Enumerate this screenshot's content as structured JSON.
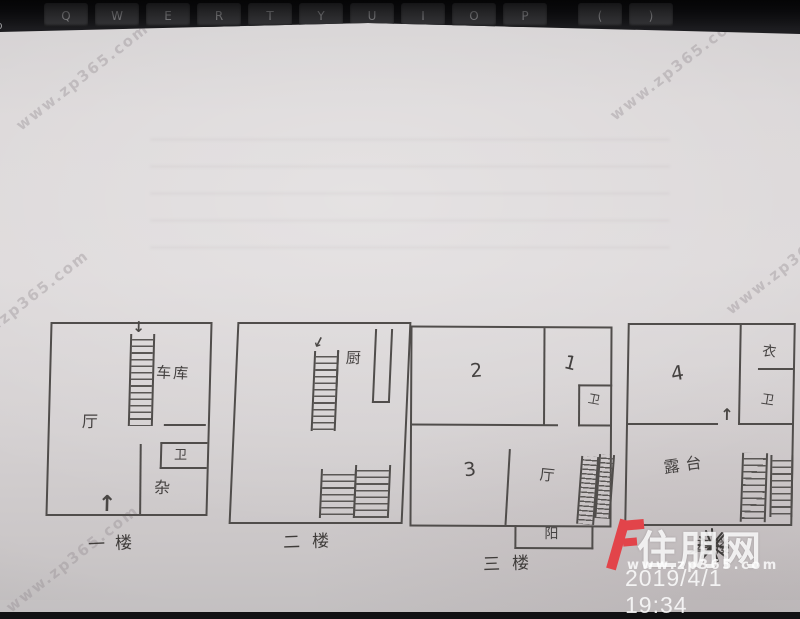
{
  "keyboard": {
    "keys": [
      "Q",
      "W",
      "E",
      "R",
      "T",
      "Y",
      "U",
      "I",
      "O",
      "P",
      "(",
      ")"
    ],
    "partial_key": "Tab"
  },
  "icons": {
    "up_arrow": "↑",
    "down_arrow": "↓"
  },
  "floorplans": [
    {
      "caption": "一楼",
      "labels": {
        "hall": "厅",
        "garage": "车库",
        "bath": "卫",
        "storage": "杂"
      }
    },
    {
      "caption": "二楼",
      "labels": {
        "kitchen": "厨"
      }
    },
    {
      "caption": "三楼",
      "labels": {
        "room2": "2",
        "room1": "1",
        "bath": "卫",
        "room3": "3",
        "hall": "厅",
        "balcony": "阳"
      }
    },
    {
      "caption": "四楼",
      "labels": {
        "room4": "4",
        "closet": "衣",
        "bath": "卫",
        "terrace": "露台"
      }
    }
  ],
  "watermark": {
    "brand": "住朋网",
    "site": "www.zp365.com",
    "timestamp": "2019/4/1 19:34",
    "diagonal_text": "www.zp365.com",
    "brand_color": "#e2444a"
  }
}
